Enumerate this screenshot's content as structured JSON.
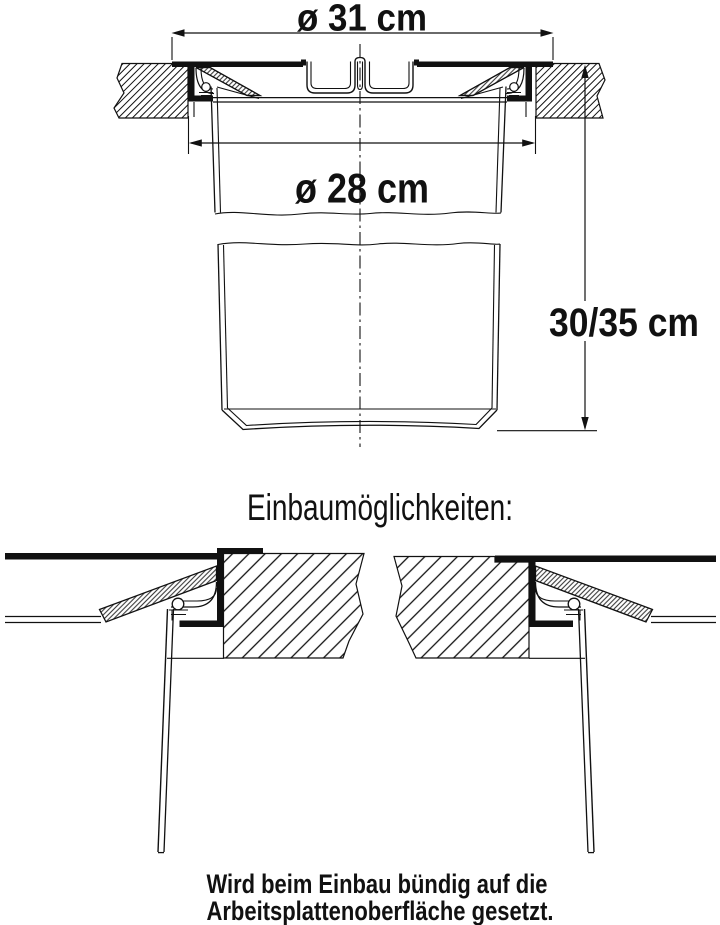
{
  "page": {
    "background": "#ffffff",
    "ink_color": "#111111",
    "subject": "Technical drawing of a built-in countertop waste bin (cross-section and installation options)"
  },
  "figure": {
    "dimensions": {
      "rim_outer_diameter_label": "ø 31 cm",
      "opening_diameter_label": "ø 28 cm",
      "bin_depth_label": "30/35 cm"
    }
  },
  "installation": {
    "heading": "Einbaumöglichkeiten:",
    "caption_line1": "Wird beim Einbau bündig auf die",
    "caption_line2": "Arbeitsplattenoberfläche gesetzt."
  }
}
